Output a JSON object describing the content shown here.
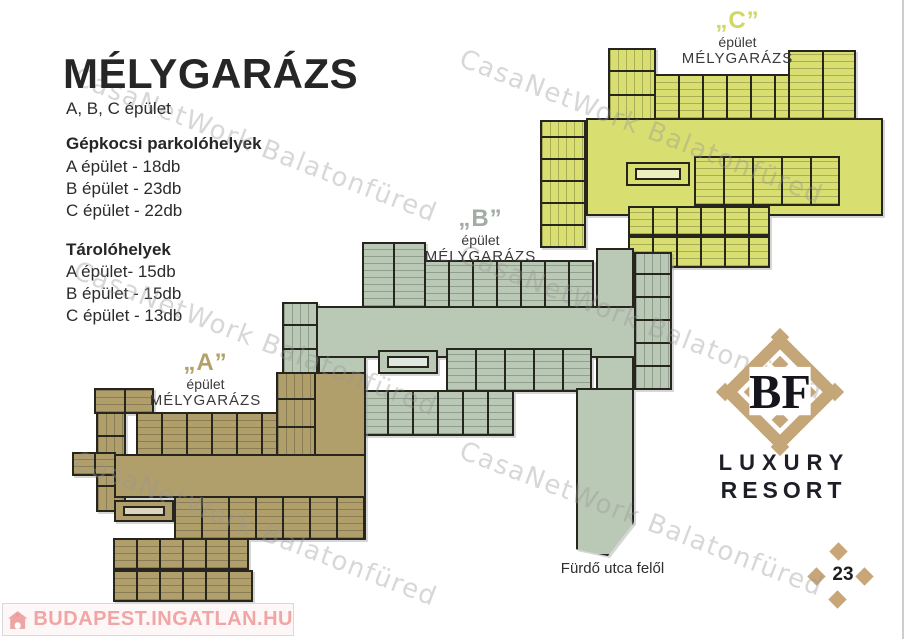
{
  "header": {
    "title": "MÉLYGARÁZS",
    "subtitle": "A, B, C épület"
  },
  "stats": {
    "parking_title": "Gépkocsi parkolóhelyek",
    "parking": [
      "A épület - 18db",
      "B épület - 23db",
      "C épület - 22db"
    ],
    "storage_title": "Tárolóhelyek",
    "storage": [
      "A épület- 15db",
      "B épület - 15db",
      "C épület - 13db"
    ]
  },
  "buildings": {
    "a": {
      "quote": "„A”",
      "line1": "épület",
      "line2": "MÉLYGARÁZS",
      "fill": "#b19f6b"
    },
    "b": {
      "quote": "„B”",
      "line1": "épület",
      "line2": "MÉLYGARÁZS",
      "fill": "#bac9b5"
    },
    "c": {
      "quote": "„C”",
      "line1": "épület",
      "line2": "MÉLYGARÁZS",
      "fill": "#d8de70"
    }
  },
  "logo": {
    "monogram": "BF",
    "line1": "LUXURY",
    "line2": "RESORT",
    "accent": "#c5a679"
  },
  "footer": {
    "street_label": "Fürdő utca felől",
    "page_number": "23",
    "portal_logo": "BUDAPEST.INGATLAN.HU"
  },
  "watermark": {
    "text": "CasaNetWork Balatonfüred"
  }
}
